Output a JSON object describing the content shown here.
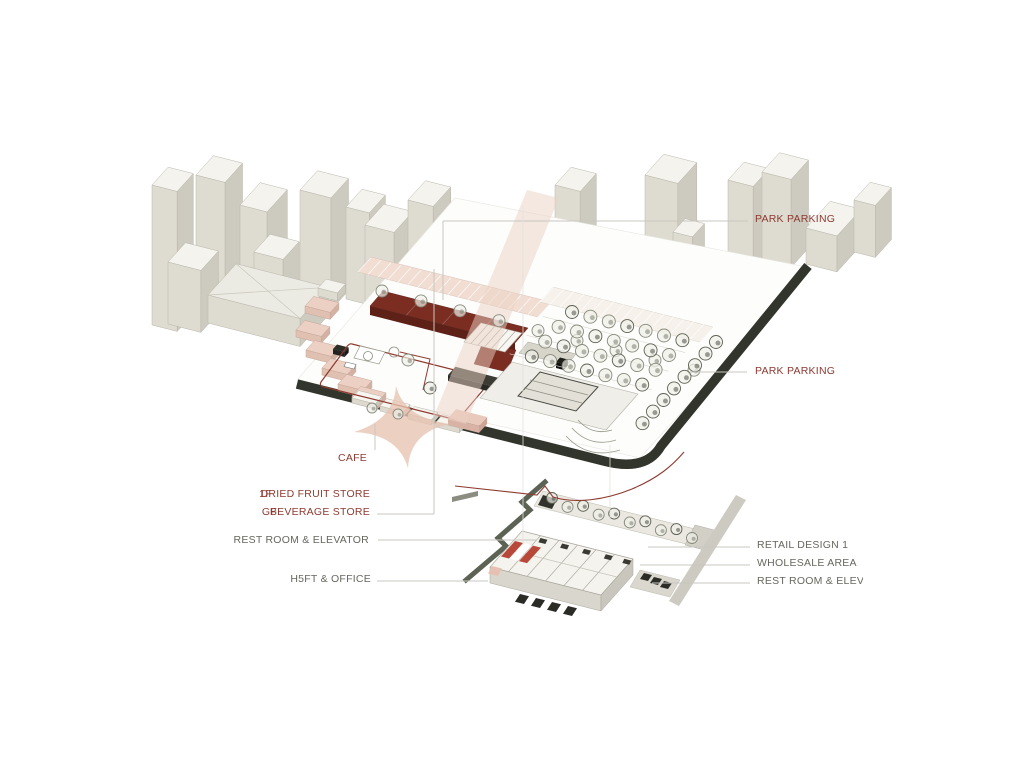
{
  "canvas": {
    "width": 1024,
    "height": 768,
    "background": "#ffffff"
  },
  "colors": {
    "label_red": "#8e3a30",
    "label_gray": "#67675f",
    "leader_line": "#c9c7c1",
    "roof_red": "#7b2d22",
    "roof_red_side": "#5e2118",
    "road_dark": "#31352b",
    "salmon_band": "#ecd2c3",
    "salmon_star": "#e7c3b1",
    "stall_pink": "#ecd0c3",
    "canopy_pink": "#f1ddd2",
    "context_top": "#f4f3ee",
    "context_side_light": "#dedbd1",
    "context_side_dark": "#cdcabf",
    "path_olive": "#5d6354",
    "gray_band": "#cdcac1",
    "tree_stroke": "#878a7b",
    "awning_red": "#b23a2a"
  },
  "labels": {
    "park_parking_top": "PARK PARKING",
    "park_parking_right": "PARK PARKING",
    "cafe": "CAFE",
    "dried_fruit_floor": "1F",
    "dried_fruit_store": "DRIED FRUIT STORE",
    "beverage_floor": "GF",
    "beverage_store": "BEVERAGE STORE",
    "rest_room_elevator_left": "REST ROOM & ELEVATOR",
    "shift_office": "H5FT & OFFICE",
    "retail_design_1": "RETAIL DESIGN 1",
    "wholesale_area": "WHOLESALE AREA",
    "rest_room_elevator_right": "REST ROOM & ELEVATOR"
  }
}
